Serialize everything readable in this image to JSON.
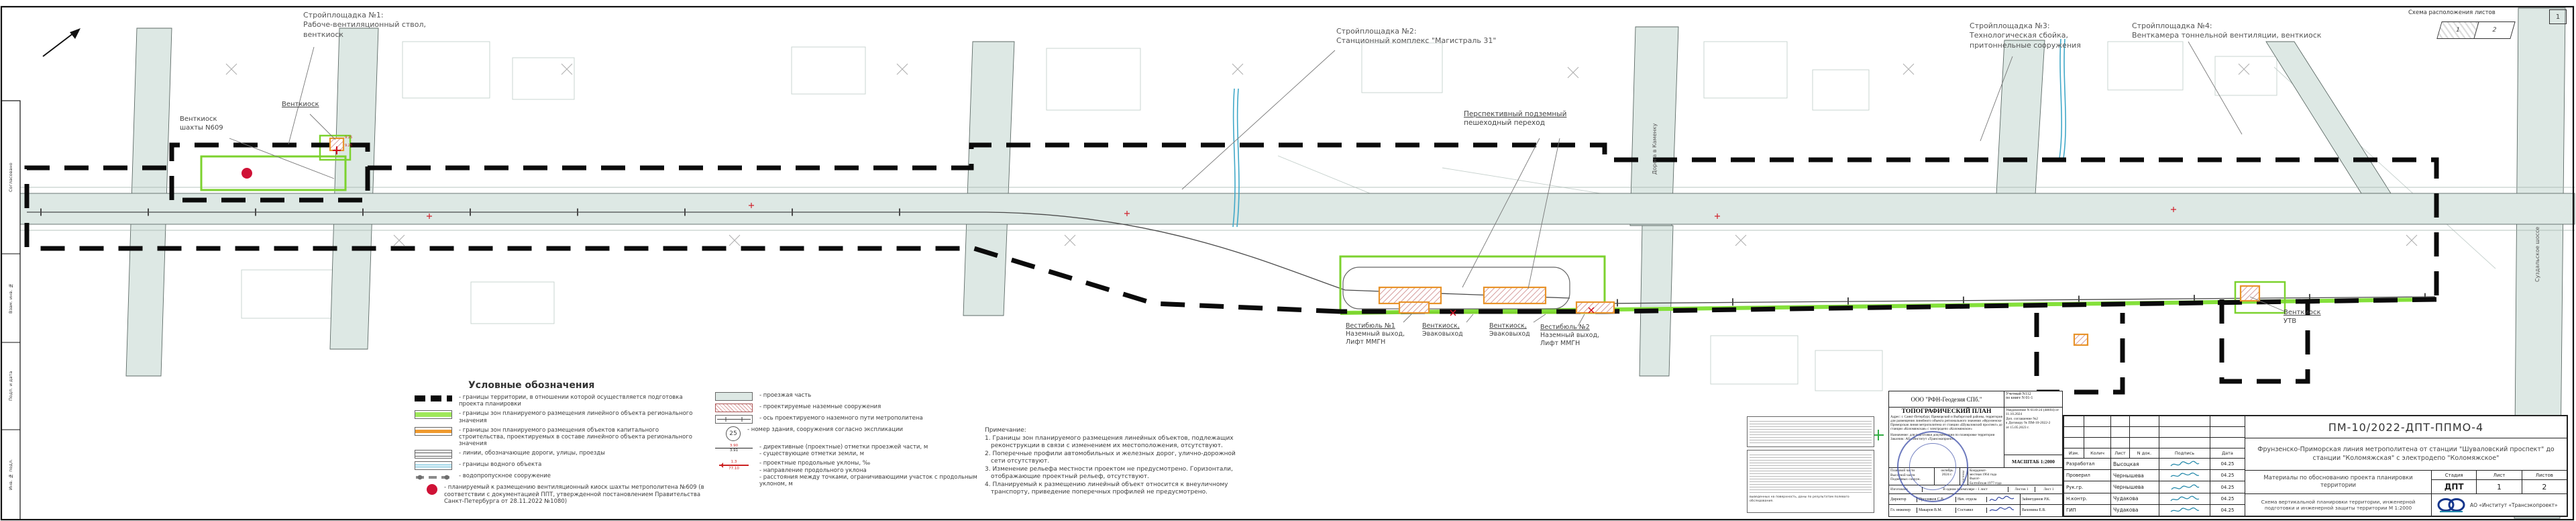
{
  "scheme_box": {
    "title": "Схема расположения листов",
    "cell1": "1",
    "cell2": "2",
    "corner": "1"
  },
  "frame": {
    "strip": [
      "Согласовано",
      "Взам. инв. №",
      "Подп. и дата",
      "Инв. № подл."
    ]
  },
  "callouts": {
    "site1": {
      "l1": "Стройплощадка №1:",
      "l2": "Рабоче-вентиляционный ствол,",
      "l3": "венткиоск"
    },
    "site2": {
      "l1": "Стройплощадка №2:",
      "l2": "Станционный комплекс \"Магистраль 31\""
    },
    "site3": {
      "l1": "Стройплощадка №3:",
      "l2": "Технологическая сбойка,",
      "l3": "притоннельные сооружения"
    },
    "site4": {
      "l1": "Стройплощадка №4:",
      "l2": "Венткамера тоннельной вентиляции, венткиоск"
    }
  },
  "map_labels": {
    "kiosk609": {
      "l1": "Венткиоск",
      "l2": "шахты N609"
    },
    "kiosk_left": {
      "l1": "Венткиоск"
    },
    "ped": {
      "l1": "Перспективный подземный",
      "l2": "пешеходный переход"
    },
    "vest1": {
      "l1": "Вестибюль №1",
      "l2": "Наземный выход,",
      "l3": "Лифт ММГН"
    },
    "evac1": {
      "l1": "Венткиоск,",
      "l2": "Эваковыход"
    },
    "evac2": {
      "l1": "Венткиоск,",
      "l2": "Эваковыход"
    },
    "vest2": {
      "l1": "Вестибюль №2",
      "l2": "Наземный выход,",
      "l3": "Лифт ММГН"
    },
    "utv": {
      "l1": "Венткиоск",
      "l2": "УТВ"
    },
    "kamenka": "Дорога в Каменку",
    "suzdal": "Суздальское шоссе",
    "elev": "9.25"
  },
  "legend": {
    "title": "Условные обозначения",
    "left": [
      "- границы территории, в отношении которой осуществляется подготовка проекта планировки",
      "- границы зон планируемого размещения линейного объекта регионального значения",
      "- границы зон планируемого размещения объектов капитального строительства, проектируемых в составе линейного объекта регионального значения",
      "- линии, обозначающие дороги, улицы, проезды",
      "- границы водного объекта",
      "- водопропускное сооружение",
      "- планируемый к размещению вентиляционный киоск шахты метрополитена №609 (в соответствии с документацией ППТ, утвержденной постановлением Правительства Санкт-Петербурга от 28.11.2022 №1080)"
    ],
    "right": [
      "- проезжая часть",
      "- проектируемые наземные сооружения",
      "- ось проектируемого наземного пути метрополитена",
      "- номер здания, сооружения согласно экспликации",
      "- директивные (проектные) отметки проезжей части, м\n- существующие отметки земли, м",
      "- проектные продольные уклоны, ‰\n- направление продольного уклона\n- расстояния между точками, ограничивающими участок с продольным уклоном, м"
    ],
    "bldg_number": "25",
    "mark_top": "3.90",
    "mark_bottom": "3.91",
    "slope_value": "1.3",
    "slope_dist": "77.10"
  },
  "notes": {
    "title": "Примечание:",
    "items": [
      "1. Границы зон планируемого размещения линейных объектов, подлежащих реконструкции в связи с изменением их местоположения, отсутствуют.",
      "2. Поперечные профили автомобильных и железных дорог, улично-дорожной сети отсутствуют.",
      "3. Изменение рельефа местности проектом не предусмотрено. Горизонтали, отображающие проектный рельеф, отсутствуют.",
      "4. Планируемый к размещению линейный объект относится к внеуличному транспорту, приведение поперечных профилей не предусмотрено."
    ]
  },
  "fine_print": {
    "box2_tail": "выведенных на поверхность, даны по результатам полевого обследования."
  },
  "geo_stamp": {
    "org": "ООО \"РФН-Геодезия СПб.\"",
    "account": "Учетный N112\nпо книге N 01-1",
    "doc_type": "ТОПОГРАФИЧЕСКИЙ ПЛАН",
    "address": "Адрес: г. Санкт-Петербург, Приморский и Выборгский районы, территория для размещения линейного объекта регионального значения «Фрунзенско-Приморская линия метрополитена от станции «Шуваловский проспект» до станции «Коломяжская» с электродепо «Коломяжское»",
    "notification": "Уведомление N 6110-24 (48694) от 11.10.2024\nДоп. соглашение №2\nк Договору № ПМ-10-2022-2\nот 15.05.2023 г.",
    "purpose": "Назначение: для подготовки документации по планировке территории",
    "customer": "Заказчик: АО «Институт «Трансэкопроект»",
    "scale": "МАСШТАБ 1:2000",
    "parts": "Плановой части\nВысотной части\nПодземных сооруж.",
    "date": "октябрь\n2024 г.",
    "systems": "системы",
    "coords": "Координат-\nместная 1964 года\nВысот-\nБалтийская 1977 года",
    "made": "Изготовлен",
    "copies": "В одном экземпляре - 1 лист",
    "sheets": "Листов 1",
    "sheet": "Лист 1",
    "r5": [
      "Директор",
      "Пресняков С.В.",
      "Нач. отдела",
      "Зайнетдинов Р.К."
    ],
    "r6": [
      "Гл. инженер",
      "Макаров В.М.",
      "Составил",
      "Вахонина Е.В."
    ]
  },
  "title_block": {
    "code": "ПМ-10/2022-ДПТ-ППМО-4",
    "project": "Фрунзенско-Приморская линия метрополитена от станции \"Шуваловский проспект\" до станции \"Коломяжская\" с электродепо \"Коломяжское\"",
    "cols": [
      "Изм.",
      "Колич",
      "Лист",
      "N док.",
      "Подпись",
      "Дата"
    ],
    "rows": [
      {
        "role": "Разработал",
        "name": "Высоцкая",
        "date": "04.25"
      },
      {
        "role": "Проверил",
        "name": "Чернышева",
        "date": "04.25"
      },
      {
        "role": "Рук.гр.",
        "name": "Чернышева",
        "date": "04.25"
      },
      {
        "role": "Н.контр.",
        "name": "Чудакова",
        "date": "04.25"
      },
      {
        "role": "ГИП",
        "name": "Чудакова",
        "date": "04.25"
      }
    ],
    "materials": "Материалы по обоснованию проекта планировки территории",
    "stage_label": "Стадия",
    "sheet_label": "Лист",
    "sheets_label": "Листов",
    "stage": "ДПТ",
    "sheet": "1",
    "sheets": "2",
    "subtitle": "Схема вертикальной планировки территории, инженерной подготовки и инженерной защиты территории М 1:2000",
    "org": "АО «Институт «Трансэкопроект»"
  }
}
